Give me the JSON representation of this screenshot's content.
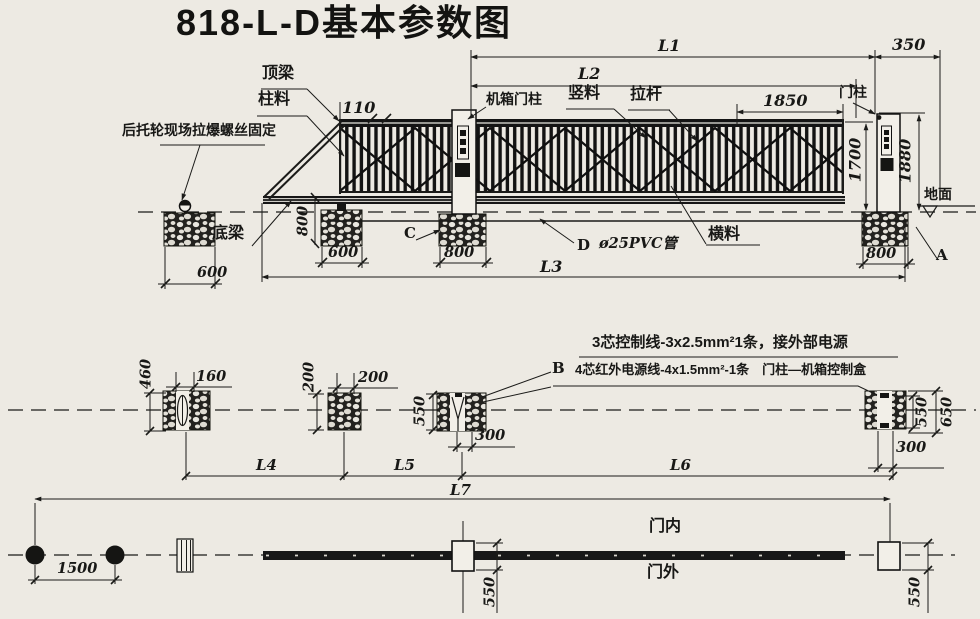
{
  "title": "818-L-D基本参数图",
  "colors": {
    "paper": "#edeae3",
    "ink": "#1b1b19"
  },
  "elev": {
    "ding_liang": "顶梁",
    "zhu_liao": "柱料",
    "hou_tuo_lun": "后托轮现场拉爆螺丝固定",
    "d110": "110",
    "ji_xiang_men_zhu": "机箱门柱",
    "L2": "L2",
    "shu_liao": "竖料",
    "la_gan": "拉杆",
    "L1": "L1",
    "d1850": "1850",
    "men_zhu": "门柱",
    "d350": "350",
    "d1700": "1700",
    "d1880": "1880",
    "di_mian": "地面",
    "di_liang": "底梁",
    "d800_left": "800",
    "d600_left": "600",
    "d600_mid": "600",
    "ref_c": "C",
    "d800_mid": "800",
    "ref_d": "D",
    "pvc": "ø25PVC管",
    "heng_liao": "横料",
    "L3": "L3",
    "d800_right": "800",
    "ref_a": "A"
  },
  "plan": {
    "wire1": "3芯控制线-3x2.5mm²1条，接外部电源",
    "ref_b": "B",
    "wire2": "4芯红外电源线-4x1.5mm²-1条　门柱—机箱控制盒",
    "d460": "460",
    "d160": "160",
    "d200v": "200",
    "d200h": "200",
    "d550_mid": "550",
    "d300_mid": "300",
    "d550_right": "550",
    "d650_right": "650",
    "d300_right": "300",
    "L4": "L4",
    "L5": "L5",
    "L6": "L6"
  },
  "track": {
    "L7": "L7",
    "d1500": "1500",
    "men_nei": "门内",
    "men_wai": "门外",
    "d550_mid": "550",
    "d550_right": "550"
  }
}
